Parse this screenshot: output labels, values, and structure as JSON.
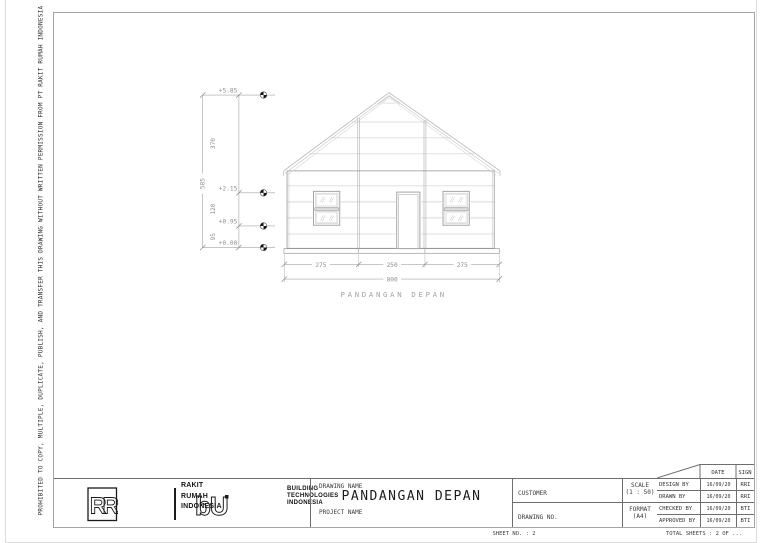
{
  "page": {
    "side_note": "PROHIBITED TO COPY, MULTIPLE, DUPLICATE, PUBLISH, AND TRANSFER THIS DRAWING WITHOUT WRITTEN PERMISSION FROM PT RAKIT RUMAH INDONESIA"
  },
  "elevation": {
    "view_title": "PANDANGAN DEPAN",
    "level_marks": [
      "+5.85",
      "+2.15",
      "+0.95",
      "+0.00"
    ],
    "height_total": "585",
    "height_segments": [
      "370",
      "120",
      "95"
    ],
    "width_total": "800",
    "width_segments": [
      "275",
      "250",
      "275"
    ]
  },
  "title_block": {
    "company_rr": {
      "monogram": "RR",
      "line1": "RAKIT",
      "line2": "RUMAH",
      "line3": "INDONESIA"
    },
    "company_bt": {
      "monogram": "bU",
      "line1": "BUILDING",
      "line2": "TECHNOLOGIES",
      "line3": "INDONESIA"
    },
    "drawing_name_label": "DRAWING NAME",
    "drawing_name": "PANDANGAN DEPAN",
    "project_name_label": "PROJECT NAME",
    "project_name": "",
    "customer_label": "CUSTOMER",
    "customer": "",
    "drawing_no_label": "DRAWING NO.",
    "drawing_no": "",
    "scale_label": "SCALE",
    "scale_value": "(1 : 50)",
    "format_label": "FORMAT",
    "format_value": "(A4)",
    "signoff": {
      "date_header": "DATE",
      "sign_header": "SIGN",
      "rows": [
        {
          "role": "DESIGN BY",
          "date": "16/09/20",
          "sign": "RRI"
        },
        {
          "role": "DRAWN BY",
          "date": "16/09/20",
          "sign": "RRI"
        },
        {
          "role": "CHECKED BY",
          "date": "16/09/20",
          "sign": "BTI"
        },
        {
          "role": "APPROVED BY",
          "date": "16/09/20",
          "sign": "BTI"
        }
      ]
    }
  },
  "footer": {
    "sheet_no_text": "SHEET NO. : 2",
    "total_sheets_text": "TOTAL SHEETS : 2 OF ..."
  }
}
